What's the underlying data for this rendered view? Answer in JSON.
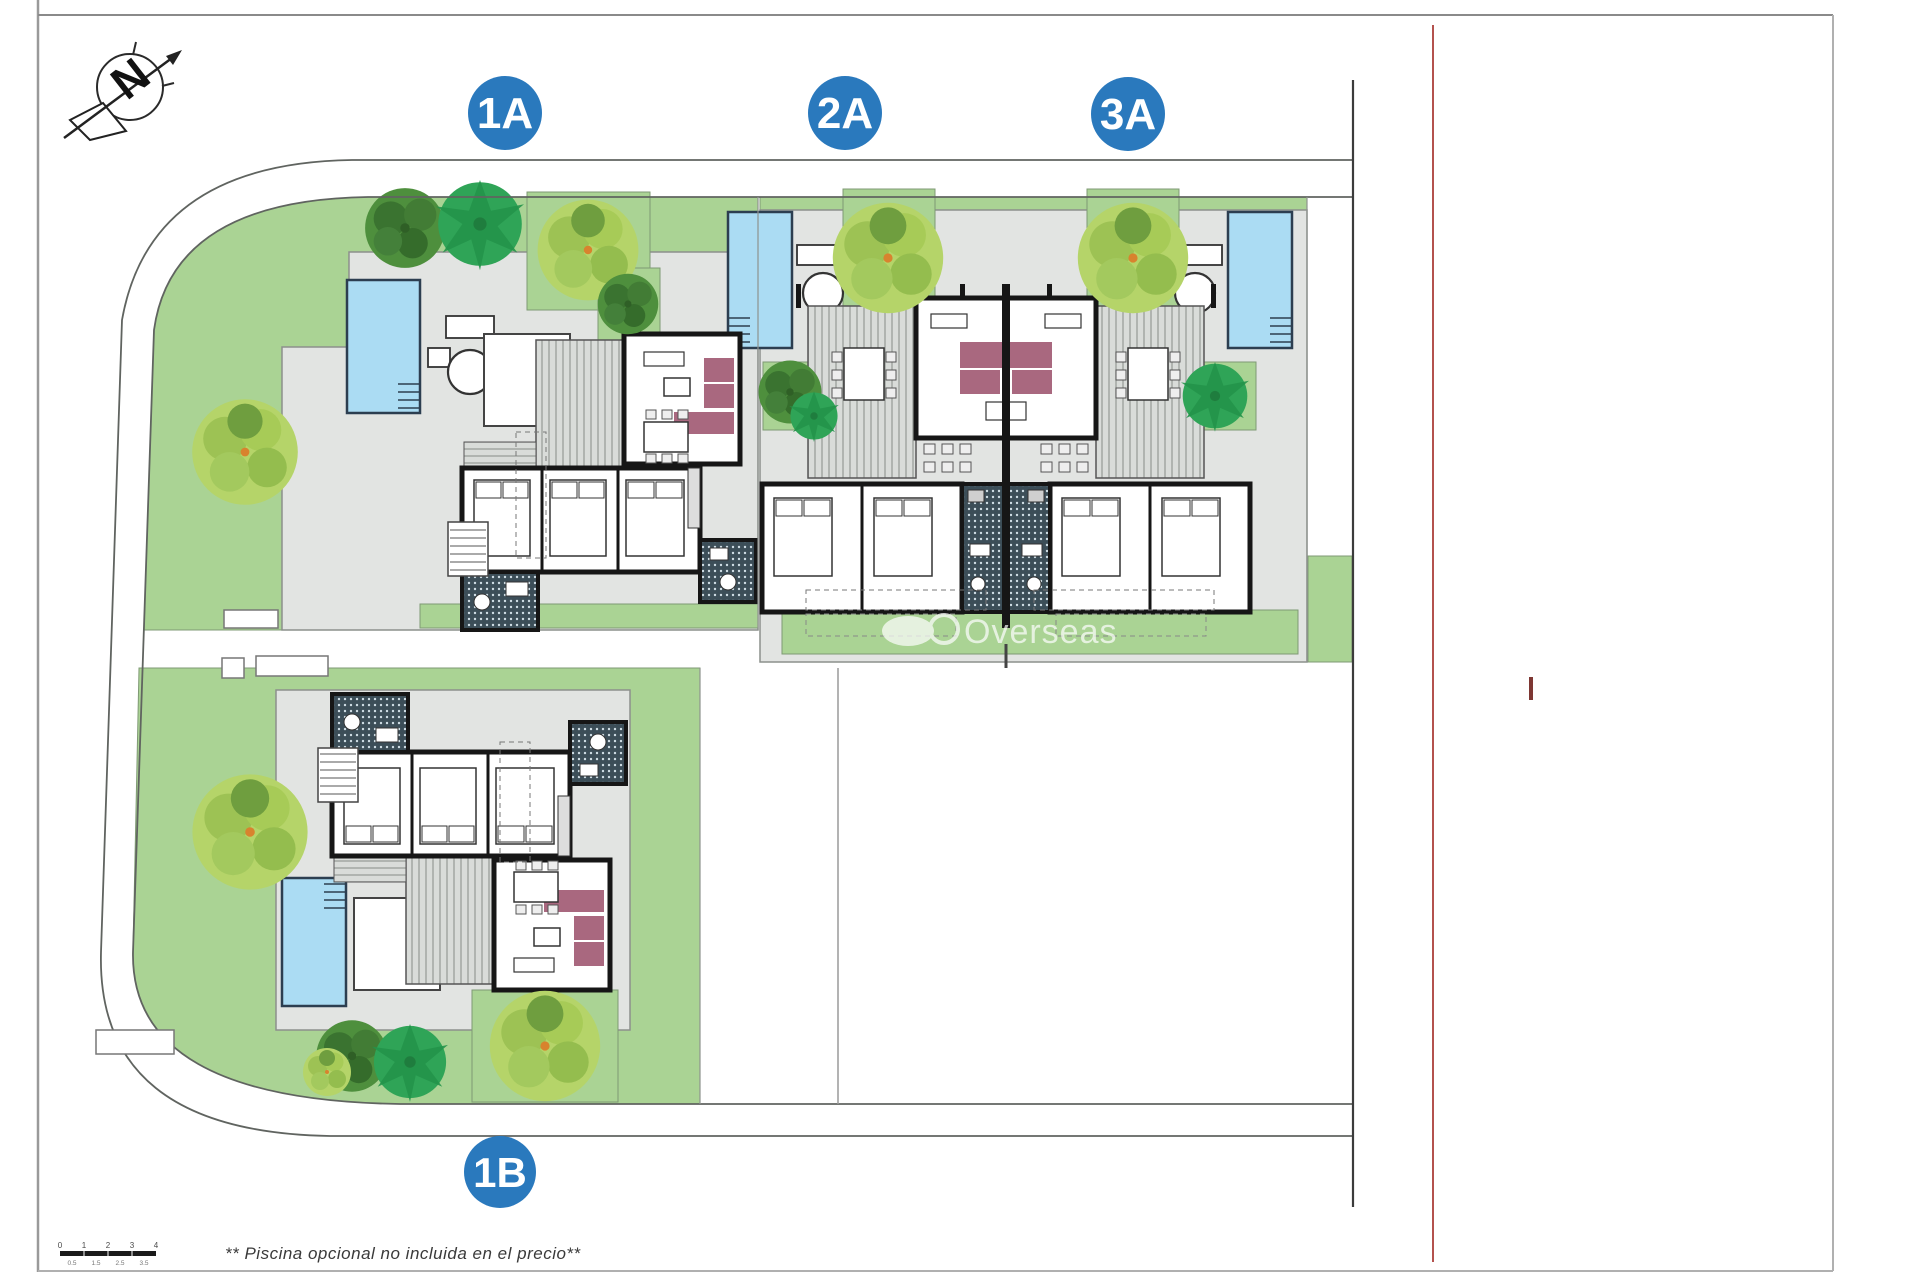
{
  "plan": {
    "units": [
      {
        "label": "1A"
      },
      {
        "label": "2A"
      },
      {
        "label": "3A"
      },
      {
        "label": "1B"
      }
    ],
    "compass": {
      "letter": "N"
    },
    "watermark": {
      "text": "Overseas"
    },
    "footnote": "** Piscina opcional no incluida en el precio**",
    "scale_bar": {
      "major": [
        "0",
        "1",
        "2",
        "3",
        "4"
      ],
      "minor": [
        "0.5",
        "1.5",
        "2.5",
        "3.5"
      ]
    },
    "colors": {
      "badge_blue": "#2a79bd",
      "garden_green": "#aad394",
      "pool_blue": "#abdcf3",
      "terrace_gray": "#e2e4e2",
      "wall_black": "#161616",
      "sofa_mauve": "#a9687f",
      "bath_tile": "#3c4e58",
      "red_line": "#b4524e",
      "road_gray": "#606460"
    }
  }
}
